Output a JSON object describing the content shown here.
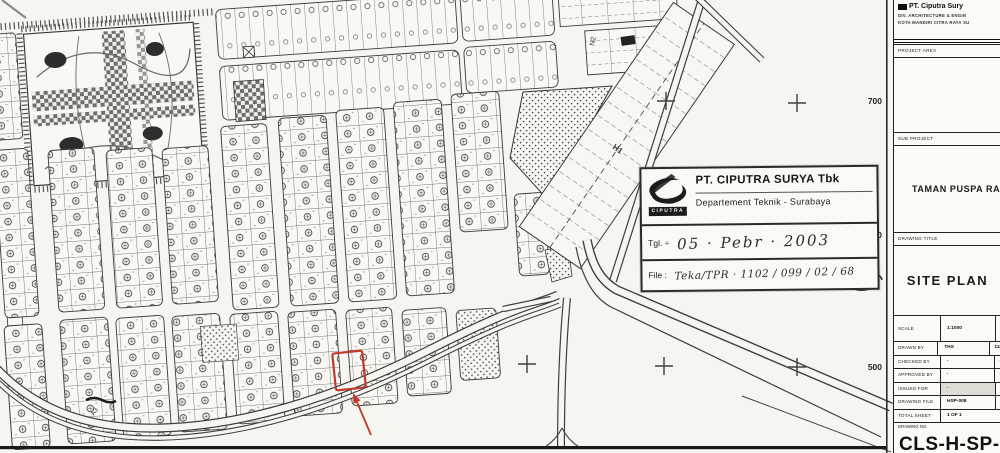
{
  "map": {
    "edge_labels": [
      "700",
      "600",
      "500"
    ],
    "street_labels": [
      "N2",
      "H1",
      "A3"
    ]
  },
  "stamp": {
    "logo_text": "CIPUTRA",
    "company": "PT. CIPUTRA SURYA Tbk",
    "department": "Departement Teknik - Surabaya",
    "date_label": "Tgl. ÷",
    "date_value": "05 · Pebr · 2003",
    "file_label": "File :",
    "file_value": "Teka/TPR   ·   1102 / 099 / 02 / 68"
  },
  "titleblock": {
    "company_line1": "PT. Ciputra Sury",
    "company_line2": "DIV. ARCHITECTURE & ENGIN",
    "company_line3": "KOTA MANDIRI CITRA RAYA SU",
    "project_area_label": "PROJECT AREA",
    "sub_project_label": "SUB PROJECT",
    "sub_project_value": "TAMAN PUSPA RA",
    "drawing_title_label": "DRAWING TITLE",
    "drawing_title_value": "SITE PLAN",
    "rows": [
      {
        "label": "SCALE",
        "value": "1:1000",
        "extra": ""
      },
      {
        "label": "DRAWN BY",
        "value": "THS",
        "extra": "12/"
      },
      {
        "label": "CHECKED BY",
        "value": "-",
        "extra": "·"
      },
      {
        "label": "APPROVED BY",
        "value": "-",
        "extra": "·"
      },
      {
        "label": "ISSUED FOR",
        "value": "·",
        "extra": ""
      },
      {
        "label": "DRAWING FILE",
        "value": "HSP-008",
        "extra": ""
      },
      {
        "label": "TOTAL SHEET",
        "value": "1   OF   1",
        "extra": ""
      }
    ],
    "drawing_no_label": "DRAWING NO.",
    "drawing_no_value": "CLS-H-SP-008"
  }
}
